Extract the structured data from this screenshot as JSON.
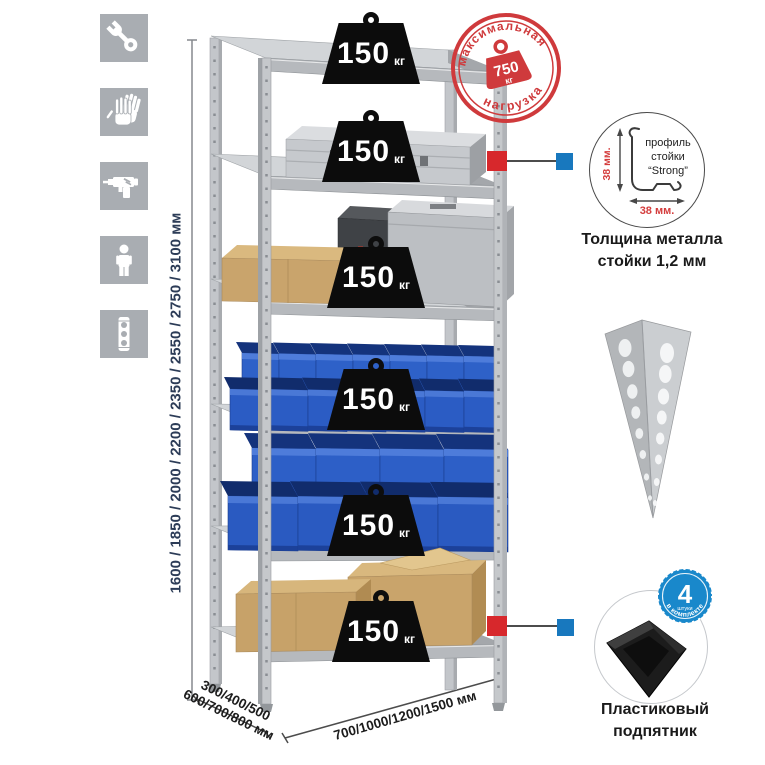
{
  "tool_icons": [
    {
      "name": "wrench"
    },
    {
      "name": "gloves"
    },
    {
      "name": "drill"
    },
    {
      "name": "person"
    },
    {
      "name": "level"
    }
  ],
  "dimensions": {
    "height_label": "1600 / 1850 / 2000 / 2200 / 2350 / 2550 / 2750 / 3100 мм",
    "depth_line1": "300/400/500",
    "depth_line2": "600/700/800 мм",
    "width_label": "700/1000/1200/1500 мм"
  },
  "badges": [
    {
      "value": "150",
      "unit": "кг"
    },
    {
      "value": "150",
      "unit": "кг"
    },
    {
      "value": "150",
      "unit": "кг"
    },
    {
      "value": "150",
      "unit": "кг"
    },
    {
      "value": "150",
      "unit": "кг"
    },
    {
      "value": "150",
      "unit": "кг"
    }
  ],
  "stamp": {
    "arc_top": "максимальная",
    "arc_bottom": "нагрузка",
    "value": "750",
    "unit": "кг"
  },
  "profile_detail": {
    "label_line1": "профиль",
    "label_line2": "стойки",
    "label_line3": "“Strong”",
    "height_dim": "38 мм.",
    "width_dim": "38 мм.",
    "caption_line1": "Толщина металла",
    "caption_line2": "стойки 1,2 мм"
  },
  "foot_detail": {
    "badge_value": "4",
    "badge_unit": "штуки",
    "badge_arc": "в комплекте",
    "caption_line1": "Пластиковый",
    "caption_line2": "подпятник"
  },
  "colors": {
    "accent_red": "#d7282c",
    "accent_blue": "#1878be",
    "stamp_red": "#cf3a3c",
    "bin_blue": "#2b5ec6",
    "metal_grey": "#c8cbce",
    "icon_grey": "#a9adb2"
  }
}
